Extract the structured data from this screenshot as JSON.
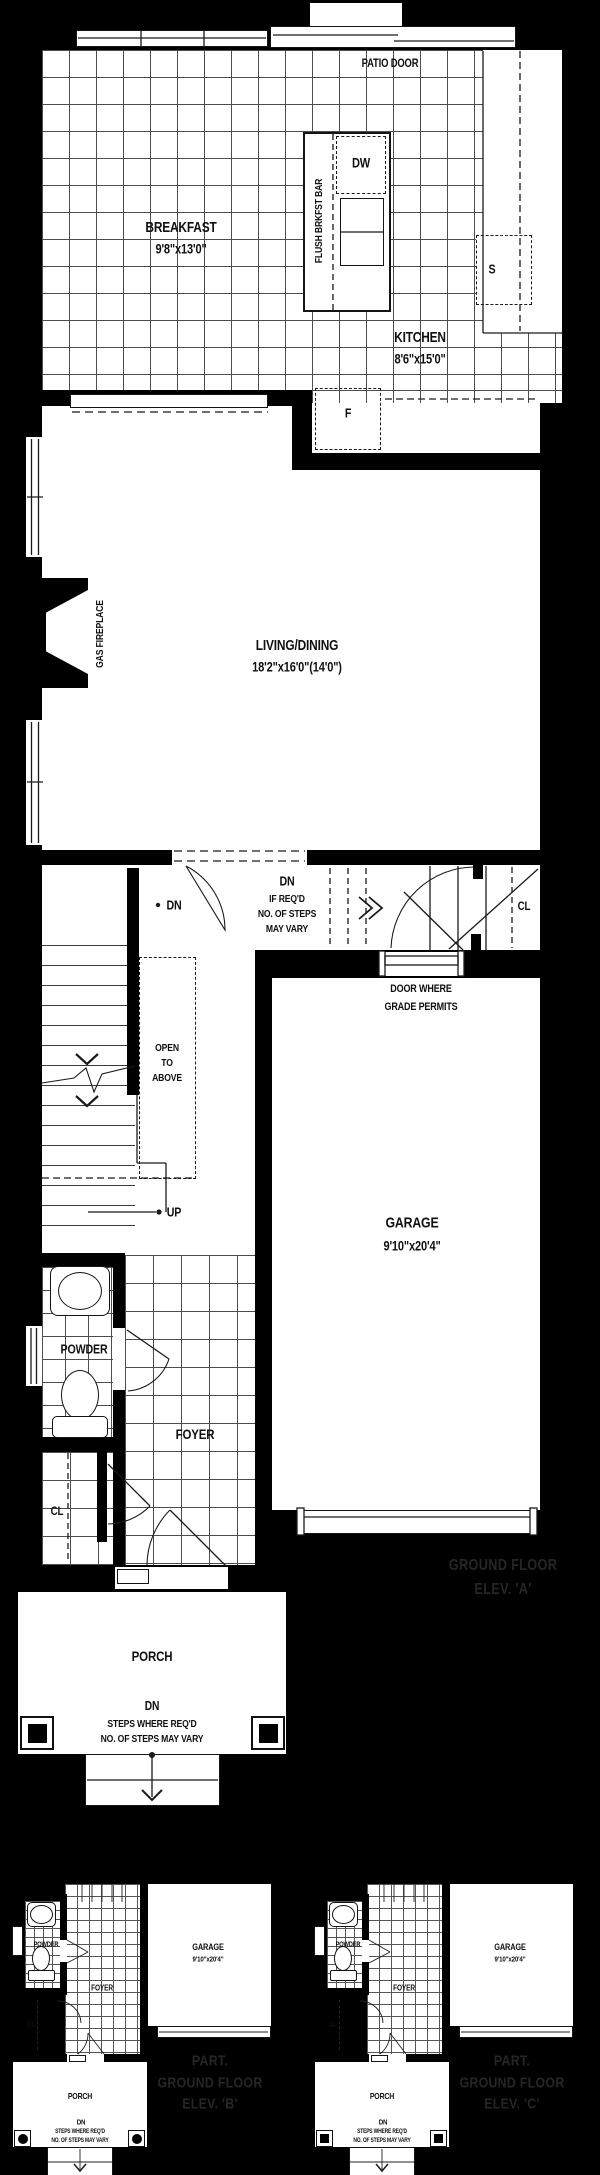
{
  "colors": {
    "background": "#000000",
    "paper": "#ffffff",
    "line": "#1a1a1a",
    "tile_line": "#4d4d4d",
    "elevation_text": "#262626"
  },
  "main": {
    "patio_door": "PATIO DOOR",
    "breakfast_name": "BREAKFAST",
    "breakfast_dims": "9'8\"x13'0\"",
    "flush_bar": "FLUSH BRKFST BAR",
    "dw": "DW",
    "sink": "S",
    "fridge": "F",
    "kitchen_name": "KITCHEN",
    "kitchen_dims": "8'6\"x15'0\"",
    "gas_fireplace": "GAS FIREPLACE",
    "living_name": "LIVING/DINING",
    "living_dims": "18'2\"x16'0\"(14'0\")",
    "dn": "DN",
    "dn_note_1": "IF REQ'D",
    "dn_note_2": "NO. OF STEPS",
    "dn_note_3": "MAY VARY",
    "cl_upper": "CL",
    "door_grade_1": "DOOR WHERE",
    "door_grade_2": "GRADE PERMITS",
    "open_1": "OPEN",
    "open_2": "TO",
    "open_3": "ABOVE",
    "up": "UP",
    "garage_name": "GARAGE",
    "garage_dims": "9'10\"x20'4\"",
    "powder": "POWDER",
    "foyer": "FOYER",
    "cl_lower": "CL",
    "porch": "PORCH",
    "porch_dn": "DN",
    "porch_note_1": "STEPS WHERE REQ'D",
    "porch_note_2": "NO. OF STEPS MAY VARY",
    "elev_1": "GROUND FLOOR",
    "elev_2": "ELEV. 'A'"
  },
  "plans_b_c": [
    {
      "powder": "POWDER",
      "foyer": "FOYER",
      "cl": "CL",
      "garage_name": "GARAGE",
      "garage_dims": "9'10\"x20'4\"",
      "porch": "PORCH",
      "dn": "DN",
      "note_1": "STEPS WHERE REQ'D",
      "note_2": "NO. OF STEPS MAY VARY",
      "elev_1": "PART.",
      "elev_2": "GROUND FLOOR",
      "elev_3": "ELEV. 'B'"
    },
    {
      "powder": "POWDER",
      "foyer": "FOYER",
      "cl": "CL",
      "garage_name": "GARAGE",
      "garage_dims": "9'10\"x20'4\"",
      "porch": "PORCH",
      "dn": "DN",
      "note_1": "STEPS WHERE REQ'D",
      "note_2": "NO. OF STEPS MAY VARY",
      "elev_1": "PART.",
      "elev_2": "GROUND FLOOR",
      "elev_3": "ELEV. 'C'"
    }
  ]
}
